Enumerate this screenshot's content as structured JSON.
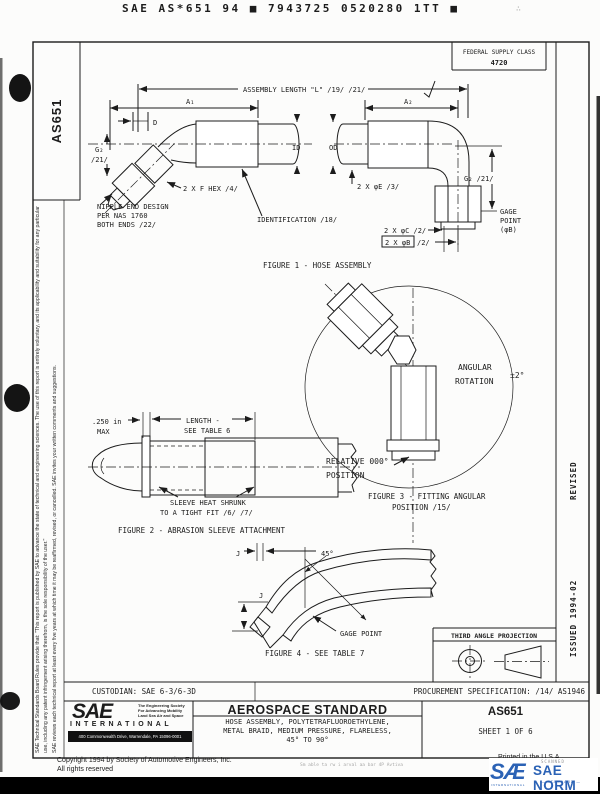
{
  "header": {
    "ocr_line": "SAE AS*651 94 ■ 7943725 0520280 1TT ■",
    "corner_mark": "∴"
  },
  "fsc": {
    "title": "FEDERAL SUPPLY CLASS",
    "value": "4720"
  },
  "sidebar": {
    "doc_number": "AS651",
    "disclaimer": "SAE Technical Standards Board Rules provide that: \"This report is published by SAE to advance the state of technical and engineering sciences. The use of this report is entirely voluntary, and its applicability and suitability for any particular use, including any patent infringement arising therefrom, is the sole responsibility of the user.\"",
    "review_note": "SAE reviews each technical report at least every five years at which time it may be reaffirmed, revised, or cancelled. SAE invites your written comments and suggestions."
  },
  "margin": {
    "revised": "REVISED",
    "issued": "ISSUED  1994-02"
  },
  "fig1": {
    "caption": "FIGURE 1 - HOSE ASSEMBLY",
    "assembly_length": "ASSEMBLY LENGTH \"L\" /19/ /21/",
    "a1": "A₁",
    "a2": "A₂",
    "d": "D",
    "g2": "G₂",
    "g2_ref": "/21/",
    "g2_right": "G₂ /21/",
    "hex": "2 X F HEX /4/",
    "phi_e": "2 X φE /3/",
    "id": "ID",
    "od": "OD",
    "nipple1": "NIPPLE END DESIGN",
    "nipple2": "PER NAS 1760",
    "nipple3": "BOTH ENDS /22/",
    "identification": "IDENTIFICATION /18/",
    "phi_c": "2 X φC /2/",
    "phi_b": "2 X φB",
    "phi_b_ref": "/2/",
    "gage1": "GAGE",
    "gage2": "POINT",
    "gage3": "(φB)"
  },
  "fig2": {
    "caption": "FIGURE 2 - ABRASION SLEEVE ATTACHMENT",
    "dim1a": ".250 in",
    "dim1b": "MAX",
    "len1": "LENGTH -",
    "len2": "SEE TABLE 6",
    "sleeve1": "SLEEVE HEAT SHRUNK",
    "sleeve2": "TO A TIGHT FIT /6/ /7/"
  },
  "fig3": {
    "caption1": "FIGURE 3 - FITTING ANGULAR",
    "caption2": "POSITION /15/",
    "ang1": "ANGULAR",
    "ang2": "ROTATION",
    "ang_tol": "±2°",
    "rel1": "RELATIVE 000°",
    "rel2": "POSITION"
  },
  "fig4": {
    "caption": "FIGURE 4 - SEE TABLE 7",
    "j_top": "J",
    "j_left": "J",
    "angle": "45°",
    "gage": "GAGE POINT"
  },
  "projection": {
    "title": "THIRD ANGLE PROJECTION"
  },
  "approval": {
    "custodian": "CUSTODIAN:  SAE 6-3/6-3D",
    "procurement": "PROCUREMENT SPECIFICATION:  /14/  AS1946"
  },
  "title_block": {
    "logo": "SAE",
    "tagline1": "The Engineering Society",
    "tagline2": "For Advancing Mobility",
    "tagline3": "Land Sea Air and Space",
    "international": "INTERNATIONAL",
    "address": "400 Commonwealth Drive, Warrendale, PA 15096-0001",
    "doc_type": "AEROSPACE STANDARD",
    "title1": "HOSE ASSEMBLY, POLYTETRAFLUOROETHYLENE,",
    "title2": "METAL BRAID, MEDIUM PRESSURE, FLARELESS,",
    "title3": "45° TO 90°",
    "doc_number": "AS651",
    "sheet": "SHEET 1 OF 6"
  },
  "footer": {
    "copyright": "Copyright 1994   by Society of Automotive Engineers, Inc.",
    "rights": "All rights reserved",
    "printed": "Printed in the U.S.A",
    "scan_note": "Sm able ta rw i arval aa bar 4P Avtiva",
    "norm_prefix": "SÆ",
    "norm_scanned": "SCANNED",
    "norm_name": "SAE NORM",
    "norm_sub_left": "INTERNATIONAL",
    "norm_sub_right": "— STANDARD —"
  },
  "colors": {
    "ink": "#1c1c1c",
    "norm_blue": "#2b62b5"
  }
}
